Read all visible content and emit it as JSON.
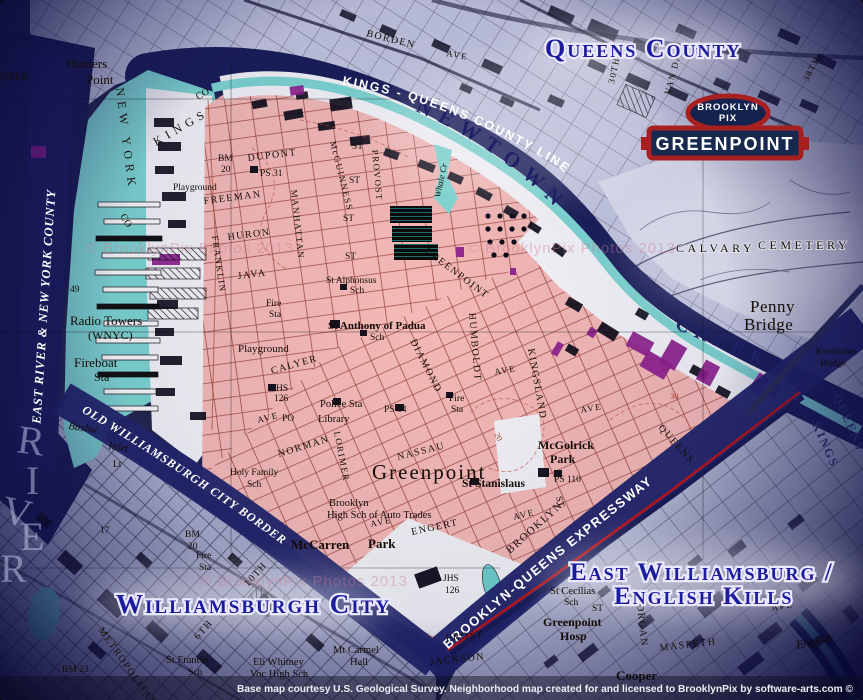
{
  "logo": {
    "brand_line1": "BROOKLYN",
    "brand_line2": "PIX",
    "neighborhood": "GREENPOINT"
  },
  "overlay": {
    "queens_county": "Queens County",
    "williamsburgh_city": "Williamsburgh City",
    "east_williamsburg": "East Williamsburg /",
    "english_kills": "English Kills"
  },
  "bands": {
    "county_line": "KINGS - QUEENS COUNTY LINE",
    "east_river": "EAST RIVER & NEW YORK COUNTY",
    "old_border": "OLD WILLIAMSBURGH CITY BORDER",
    "expressway": "BROOKLYN-QUEENS EXPRESSWAY",
    "newtown": "NEWTOWN",
    "creek": "CREEK"
  },
  "footer": {
    "credit": "Base map courtesy U.S. Geological Survey. Neighborhood map created for and licensed to BrooklynPix by software-arts.com ©"
  },
  "watermark": "© BrooklynPix Photos 2013",
  "colors": {
    "greenpoint_pink": "#f4b9b6",
    "street_maroon": "#8a3028",
    "water_cyan": "#7ed6d2",
    "deep_navy": "#1a1e58",
    "band_navy": "#22266a",
    "banner_red": "#a81f1f",
    "label_blue": "#1c1c9e",
    "industrial_purple": "#8d1f8d",
    "queens_lavender": "#c4c7e0",
    "boundary_red": "#c21515"
  },
  "map_labels": [
    {
      "t": "CENTER",
      "x": -14,
      "y": 80,
      "s": 11,
      "c": "q"
    },
    {
      "t": "Hunters",
      "x": 66,
      "y": 68,
      "s": 13,
      "c": "q"
    },
    {
      "t": "Point",
      "x": 86,
      "y": 84,
      "s": 13,
      "c": "q"
    },
    {
      "t": "NEW YORK",
      "x": 116,
      "y": 88,
      "r": 83,
      "c": "spq"
    },
    {
      "t": "KINGS",
      "x": 156,
      "y": 146,
      "r": -30,
      "c": "spq"
    },
    {
      "t": "CO",
      "x": 198,
      "y": 100,
      "r": -30,
      "s": 10,
      "c": "q"
    },
    {
      "t": "CO",
      "x": 120,
      "y": 216,
      "r": 60,
      "s": 10,
      "c": "q"
    },
    {
      "t": "BORDEN",
      "x": 366,
      "y": 36,
      "r": 14,
      "c": "st"
    },
    {
      "t": "AVE",
      "x": 446,
      "y": 56,
      "r": 10,
      "s": 9,
      "c": "st"
    },
    {
      "t": "30TH",
      "x": 614,
      "y": 84,
      "r": -78,
      "s": 9,
      "c": "st"
    },
    {
      "t": "VAN DAM",
      "x": 670,
      "y": 95,
      "r": -75,
      "s": 9,
      "c": "st"
    },
    {
      "t": "38TH",
      "x": 808,
      "y": 82,
      "r": -64,
      "s": 9,
      "c": "st"
    },
    {
      "t": "BM",
      "x": 218,
      "y": 161,
      "c": "sm"
    },
    {
      "t": "20",
      "x": 221,
      "y": 172,
      "c": "sm"
    },
    {
      "t": "DUPONT",
      "x": 248,
      "y": 161,
      "r": -7,
      "c": "st"
    },
    {
      "t": "PS 31",
      "x": 260,
      "y": 176,
      "c": "sm"
    },
    {
      "t": "Playground",
      "x": 173,
      "y": 190,
      "c": "sm"
    },
    {
      "t": "FREEMAN",
      "x": 204,
      "y": 204,
      "r": -7,
      "c": "st"
    },
    {
      "t": "HURON",
      "x": 228,
      "y": 240,
      "r": -7,
      "c": "st"
    },
    {
      "t": "JAVA",
      "x": 238,
      "y": 279,
      "r": -7,
      "c": "st"
    },
    {
      "t": "Fire",
      "x": 266,
      "y": 306,
      "c": "sm"
    },
    {
      "t": "Sta",
      "x": 269,
      "y": 317,
      "c": "sm"
    },
    {
      "t": "FRANKLIN",
      "x": 212,
      "y": 236,
      "r": 82,
      "s": 9,
      "c": "st"
    },
    {
      "t": "MANHATTAN",
      "x": 291,
      "y": 190,
      "r": 84,
      "s": 9,
      "c": "st"
    },
    {
      "t": "McGUINNESS",
      "x": 330,
      "y": 142,
      "r": 76,
      "s": 9,
      "c": "st"
    },
    {
      "t": "PROVOST",
      "x": 372,
      "y": 150,
      "r": 85,
      "s": 9,
      "c": "st"
    },
    {
      "t": "ST",
      "x": 352,
      "y": 149,
      "c": "sm"
    },
    {
      "t": "ST",
      "x": 349,
      "y": 183,
      "c": "sm"
    },
    {
      "t": "ST",
      "x": 343,
      "y": 221,
      "c": "sm"
    },
    {
      "t": "ST",
      "x": 345,
      "y": 259,
      "c": "sm"
    },
    {
      "t": "GREENPOINT",
      "x": 424,
      "y": 252,
      "r": 37,
      "c": "st"
    },
    {
      "t": "St Alphonsus",
      "x": 326,
      "y": 283,
      "c": "sm"
    },
    {
      "t": "Sch",
      "x": 350,
      "y": 293,
      "c": "sm"
    },
    {
      "t": "St Anthony of Padua",
      "x": 328,
      "y": 329,
      "s": 11,
      "c": "smb"
    },
    {
      "t": "Sch",
      "x": 370,
      "y": 340,
      "c": "sm"
    },
    {
      "t": "Playground",
      "x": 238,
      "y": 352,
      "s": 11,
      "c": "sm"
    },
    {
      "t": "CALYER",
      "x": 272,
      "y": 374,
      "r": -16,
      "c": "st"
    },
    {
      "t": "HS",
      "x": 276,
      "y": 391,
      "c": "sm"
    },
    {
      "t": "126",
      "x": 274,
      "y": 401,
      "c": "sm"
    },
    {
      "t": "PO",
      "x": 282,
      "y": 421,
      "c": "sm"
    },
    {
      "t": "Police Sta",
      "x": 320,
      "y": 407,
      "s": 10.5,
      "c": "sm"
    },
    {
      "t": "Library",
      "x": 318,
      "y": 422,
      "s": 10.5,
      "c": "sm"
    },
    {
      "t": "PS 34",
      "x": 384,
      "y": 412,
      "c": "sm"
    },
    {
      "t": "Fire",
      "x": 449,
      "y": 401,
      "c": "sm"
    },
    {
      "t": "Sta",
      "x": 451,
      "y": 412,
      "c": "sm"
    },
    {
      "t": "AVE",
      "x": 258,
      "y": 423,
      "r": -14,
      "s": 9,
      "c": "st"
    },
    {
      "t": "NORMAN",
      "x": 279,
      "y": 457,
      "r": -17,
      "c": "st"
    },
    {
      "t": "LORIMER",
      "x": 334,
      "y": 432,
      "r": 79,
      "s": 9,
      "c": "st"
    },
    {
      "t": "DIAMOND",
      "x": 410,
      "y": 341,
      "r": 63,
      "c": "st"
    },
    {
      "t": "HUMBOLDT",
      "x": 469,
      "y": 313,
      "r": 85,
      "c": "st"
    },
    {
      "t": "KINGSLAND",
      "x": 528,
      "y": 349,
      "r": 80,
      "c": "st"
    },
    {
      "t": "NASSAU",
      "x": 398,
      "y": 460,
      "r": -14,
      "c": "st"
    },
    {
      "t": "ST",
      "x": 556,
      "y": 497,
      "r": 76,
      "c": "sm"
    },
    {
      "t": "Greenpoint",
      "x": 372,
      "y": 479,
      "c": "big"
    },
    {
      "t": "Holy Family",
      "x": 230,
      "y": 475,
      "c": "sm"
    },
    {
      "t": "Sch",
      "x": 247,
      "y": 487,
      "c": "sm"
    },
    {
      "t": "Brooklyn",
      "x": 329,
      "y": 506,
      "s": 10.5,
      "c": "sm"
    },
    {
      "t": "High Sch of Auto Trades",
      "x": 327,
      "y": 518,
      "s": 10.5,
      "c": "sm"
    },
    {
      "t": "ENGERT",
      "x": 412,
      "y": 535,
      "r": -12,
      "c": "st"
    },
    {
      "t": "AVE",
      "x": 371,
      "y": 527,
      "r": -12,
      "s": 9,
      "c": "st"
    },
    {
      "t": "AVE",
      "x": 495,
      "y": 375,
      "r": -10,
      "s": 9,
      "c": "st"
    },
    {
      "t": "AVE",
      "x": 581,
      "y": 413,
      "r": -10,
      "s": 9,
      "c": "st"
    },
    {
      "t": "AVE",
      "x": 514,
      "y": 520,
      "r": -14,
      "s": 9,
      "c": "st"
    },
    {
      "t": "McGolrick",
      "x": 538,
      "y": 449,
      "s": 12,
      "c": "smb"
    },
    {
      "t": "Park",
      "x": 550,
      "y": 463,
      "s": 12,
      "c": "smb"
    },
    {
      "t": "PS 110",
      "x": 554,
      "y": 482,
      "c": "sm"
    },
    {
      "t": "St Stanislaus",
      "x": 462,
      "y": 487,
      "s": 11.5,
      "c": "smb"
    },
    {
      "t": "BROOKLYN",
      "x": 510,
      "y": 554,
      "r": -42,
      "s": 11,
      "c": "st"
    },
    {
      "t": "QUEENS",
      "x": 658,
      "y": 428,
      "r": 48,
      "c": "st"
    },
    {
      "t": "20",
      "x": 494,
      "y": 434,
      "r": 64,
      "c": "ctr"
    },
    {
      "t": "30",
      "x": 670,
      "y": 399,
      "c": "ctr"
    },
    {
      "t": "McCarren",
      "x": 291,
      "y": 549,
      "s": 13,
      "c": "smb"
    },
    {
      "t": "Park",
      "x": 368,
      "y": 548,
      "s": 13,
      "c": "smb"
    },
    {
      "t": "JHS",
      "x": 443,
      "y": 581,
      "c": "sm"
    },
    {
      "t": "126",
      "x": 445,
      "y": 593,
      "c": "sm"
    },
    {
      "t": "BM",
      "x": 185,
      "y": 537,
      "c": "sm"
    },
    {
      "t": "20",
      "x": 188,
      "y": 549,
      "c": "sm"
    },
    {
      "t": "Fire",
      "x": 196,
      "y": 558,
      "c": "sm"
    },
    {
      "t": "Sta",
      "x": 199,
      "y": 570,
      "c": "sm"
    },
    {
      "t": "Penny",
      "x": 750,
      "y": 312,
      "c": "pb"
    },
    {
      "t": "Bridge",
      "x": 744,
      "y": 330,
      "c": "pb"
    },
    {
      "t": "CALVARY",
      "x": 676,
      "y": 252,
      "c": "cem"
    },
    {
      "t": "CEMETERY",
      "x": 758,
      "y": 249,
      "c": "cem"
    },
    {
      "t": "Kosciusko",
      "x": 816,
      "y": 354,
      "c": "sm"
    },
    {
      "t": "Bridge",
      "x": 820,
      "y": 366,
      "c": "sm"
    },
    {
      "t": "QUEENS",
      "x": 833,
      "y": 396,
      "r": 66,
      "c": "cnty"
    },
    {
      "t": "KINGS",
      "x": 812,
      "y": 424,
      "r": 66,
      "c": "cnty"
    },
    {
      "t": "Whale Cr",
      "x": 440,
      "y": 198,
      "r": -78,
      "s": 9,
      "c": "ital"
    },
    {
      "t": "49",
      "x": 70,
      "y": 292,
      "c": "sm"
    },
    {
      "t": "Radio Towers",
      "x": 70,
      "y": 325,
      "s": 13,
      "c": "q"
    },
    {
      "t": "(WNYC)",
      "x": 88,
      "y": 339,
      "s": 12,
      "c": "q"
    },
    {
      "t": "Fireboat",
      "x": 74,
      "y": 367,
      "s": 13,
      "c": "q"
    },
    {
      "t": "Sta",
      "x": 94,
      "y": 381,
      "s": 12,
      "c": "q"
    },
    {
      "t": "Lt",
      "x": 113,
      "y": 467,
      "c": "sm"
    },
    {
      "t": "Bushw",
      "x": 68,
      "y": 429,
      "r": 8,
      "c": "ital"
    },
    {
      "t": "Inlet",
      "x": 108,
      "y": 449,
      "r": 8,
      "c": "ital"
    },
    {
      "t": "17",
      "x": 100,
      "y": 533,
      "c": "sm"
    },
    {
      "t": "BM 23",
      "x": 62,
      "y": 672,
      "c": "sm"
    },
    {
      "t": "METROPOLITAN",
      "x": 98,
      "y": 630,
      "r": 55,
      "c": "st"
    },
    {
      "t": "6TH",
      "x": 198,
      "y": 640,
      "r": -48,
      "c": "st"
    },
    {
      "t": "10TH",
      "x": 248,
      "y": 587,
      "r": -48,
      "c": "st"
    },
    {
      "t": "St Francis",
      "x": 166,
      "y": 663,
      "s": 10.5,
      "c": "sm"
    },
    {
      "t": "Sch",
      "x": 188,
      "y": 675,
      "c": "sm"
    },
    {
      "t": "Eli Whitney",
      "x": 253,
      "y": 665,
      "s": 10.5,
      "c": "sm"
    },
    {
      "t": "Voc High Sch",
      "x": 250,
      "y": 677,
      "s": 10.5,
      "c": "sm"
    },
    {
      "t": "Mt Carmel",
      "x": 333,
      "y": 653,
      "s": 10.5,
      "c": "sm"
    },
    {
      "t": "Hall",
      "x": 350,
      "y": 665,
      "s": 10.5,
      "c": "sm"
    },
    {
      "t": "FROST",
      "x": 446,
      "y": 641,
      "r": -6,
      "c": "st"
    },
    {
      "t": "JACKSON",
      "x": 430,
      "y": 665,
      "r": -6,
      "c": "st"
    },
    {
      "t": "ST",
      "x": 592,
      "y": 611,
      "c": "sm"
    },
    {
      "t": "Greenpoint",
      "x": 543,
      "y": 626,
      "s": 12,
      "c": "smb"
    },
    {
      "t": "Hosp",
      "x": 560,
      "y": 640,
      "s": 12,
      "c": "smb"
    },
    {
      "t": "St Cecilias",
      "x": 550,
      "y": 594,
      "s": 10.5,
      "c": "sm"
    },
    {
      "t": "Sch",
      "x": 564,
      "y": 605,
      "c": "sm"
    },
    {
      "t": "MORGAN",
      "x": 636,
      "y": 594,
      "r": 84,
      "c": "st"
    },
    {
      "t": "MASPETH",
      "x": 660,
      "y": 651,
      "r": -7,
      "c": "st"
    },
    {
      "t": "AVE",
      "x": 772,
      "y": 611,
      "r": -10,
      "s": 9,
      "c": "st"
    },
    {
      "t": "Cooper",
      "x": 616,
      "y": 680,
      "s": 13,
      "c": "smb"
    },
    {
      "t": "English",
      "x": 797,
      "y": 649,
      "r": -12,
      "s": 12,
      "c": "ital"
    },
    {
      "t": "R",
      "x": 16,
      "y": 452,
      "r": 8,
      "c": "rv"
    },
    {
      "t": "I",
      "x": 26,
      "y": 494,
      "c": "rv"
    },
    {
      "t": "V",
      "x": 0,
      "y": 522,
      "r": 12,
      "c": "rv"
    },
    {
      "t": "E",
      "x": 20,
      "y": 550,
      "c": "rv"
    },
    {
      "t": "R",
      "x": 0,
      "y": 582,
      "c": "rv"
    }
  ]
}
